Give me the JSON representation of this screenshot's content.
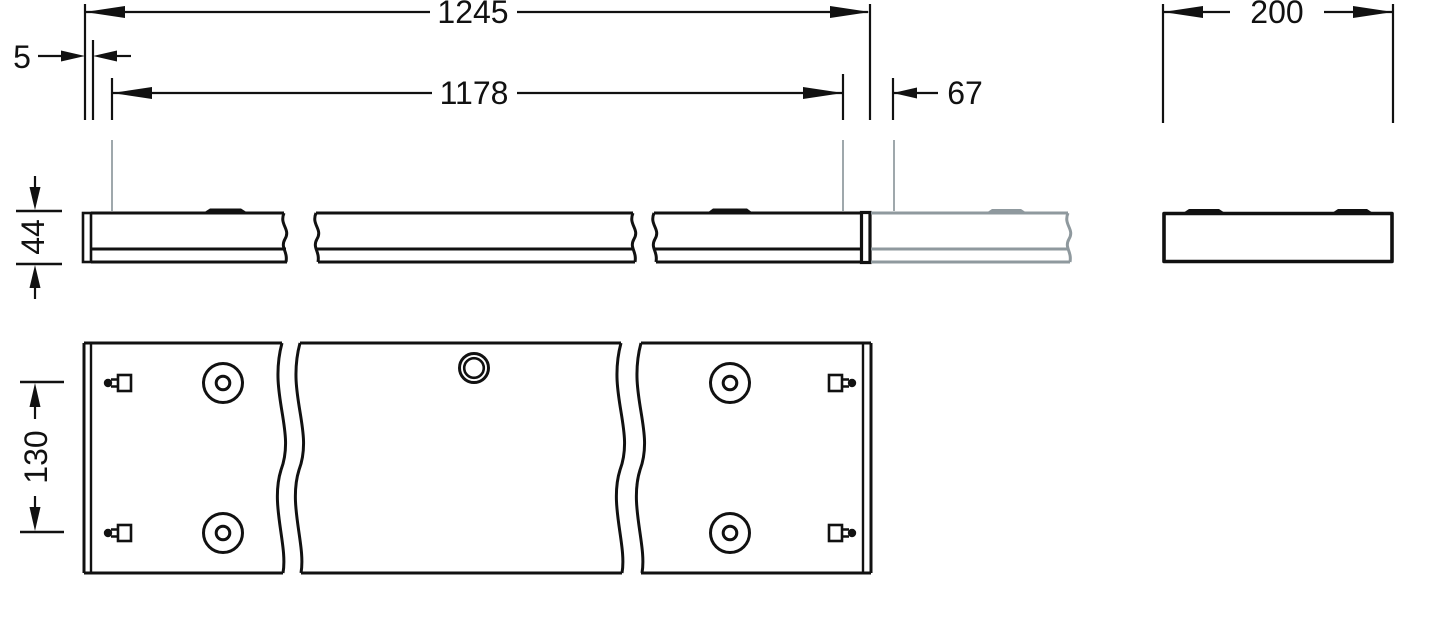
{
  "dimensions": {
    "overall_length": "1245",
    "end_cap": "5",
    "suspension_span": "1178",
    "continuation_offset": "67",
    "profile_width": "200",
    "profile_height": "44",
    "slot_spacing": "130"
  },
  "colors": {
    "line_black": "#111111",
    "continuation_gray": "#8f999e",
    "leader_gray": "#9fa8ac",
    "background": "#ffffff"
  }
}
